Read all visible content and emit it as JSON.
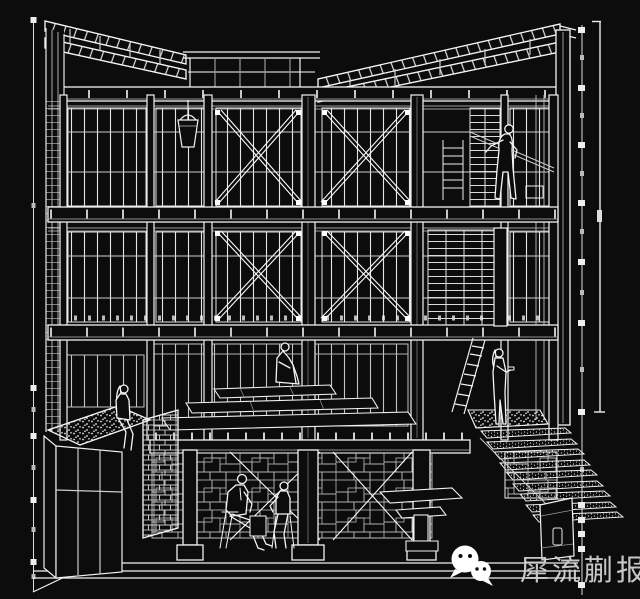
{
  "page": {
    "background_color": "#0c0c0c",
    "line_color": "#f2f2f2",
    "dim_line_color": "#bdbdbd"
  },
  "watermark": {
    "text": "犀流蒯报",
    "text_color": "#cfd2d4",
    "icon": "wechat-logo-icon",
    "icon_color": "#ffffff"
  }
}
